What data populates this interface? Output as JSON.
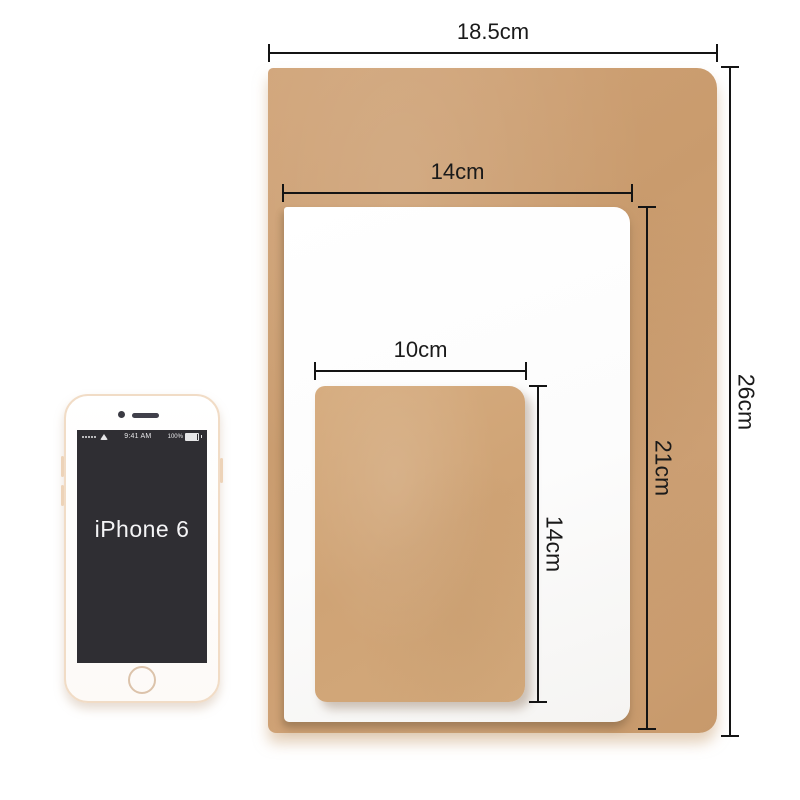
{
  "dimensions": {
    "large_width_label": "18.5cm",
    "large_height_label": "26cm",
    "medium_width_label": "14cm",
    "medium_height_label": "21cm",
    "small_width_label": "10cm",
    "small_height_label": "14cm"
  },
  "phone": {
    "model_label": "iPhone 6",
    "status_time": "9:41 AM",
    "battery_percent": "100%"
  },
  "colors": {
    "kraft_large": "#cb9e70",
    "kraft_small": "#d2a87c",
    "paper_white": "#fcfcfc",
    "dimension_line": "#141414",
    "phone_frame_gold": "#f1dcc6",
    "screen_dark": "#2f2e33",
    "background": "#ffffff"
  }
}
